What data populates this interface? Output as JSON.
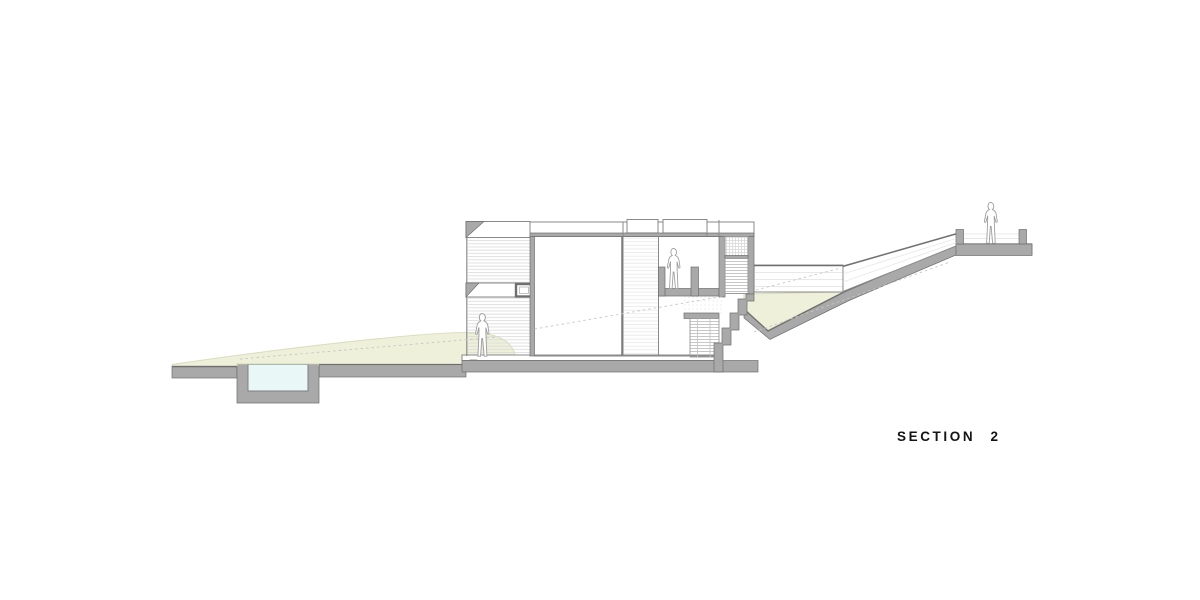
{
  "drawing": {
    "title": "SECTION 2",
    "scene": "architectural-cross-section",
    "features": [
      "sunken-pool",
      "grass-slope",
      "house-section-two-levels",
      "covered-porch",
      "main-room",
      "balcony-recess",
      "stair-tower",
      "walkway-parapet",
      "sloped-ramp-parapet",
      "upper-terrace",
      "person-on-ground-terrace",
      "person-on-balcony",
      "person-on-upper-terrace"
    ],
    "colors": {
      "background": "#ffffff",
      "cut_fill": "#a9a9a9",
      "cut_edge": "#6f6f6f",
      "line": "#8a8a8a",
      "texture": "#d9d9d9",
      "texture_light": "#e8e8e8",
      "tread": "#b9b9b9",
      "grass": "#eef0da",
      "grass_edge": "#d9dcbe",
      "water": "#e9f8f6",
      "water_edge": "#93a7a5",
      "figure_line": "#9b9b9b",
      "dash": "#c6c6c6",
      "title_color": "#141414"
    }
  }
}
